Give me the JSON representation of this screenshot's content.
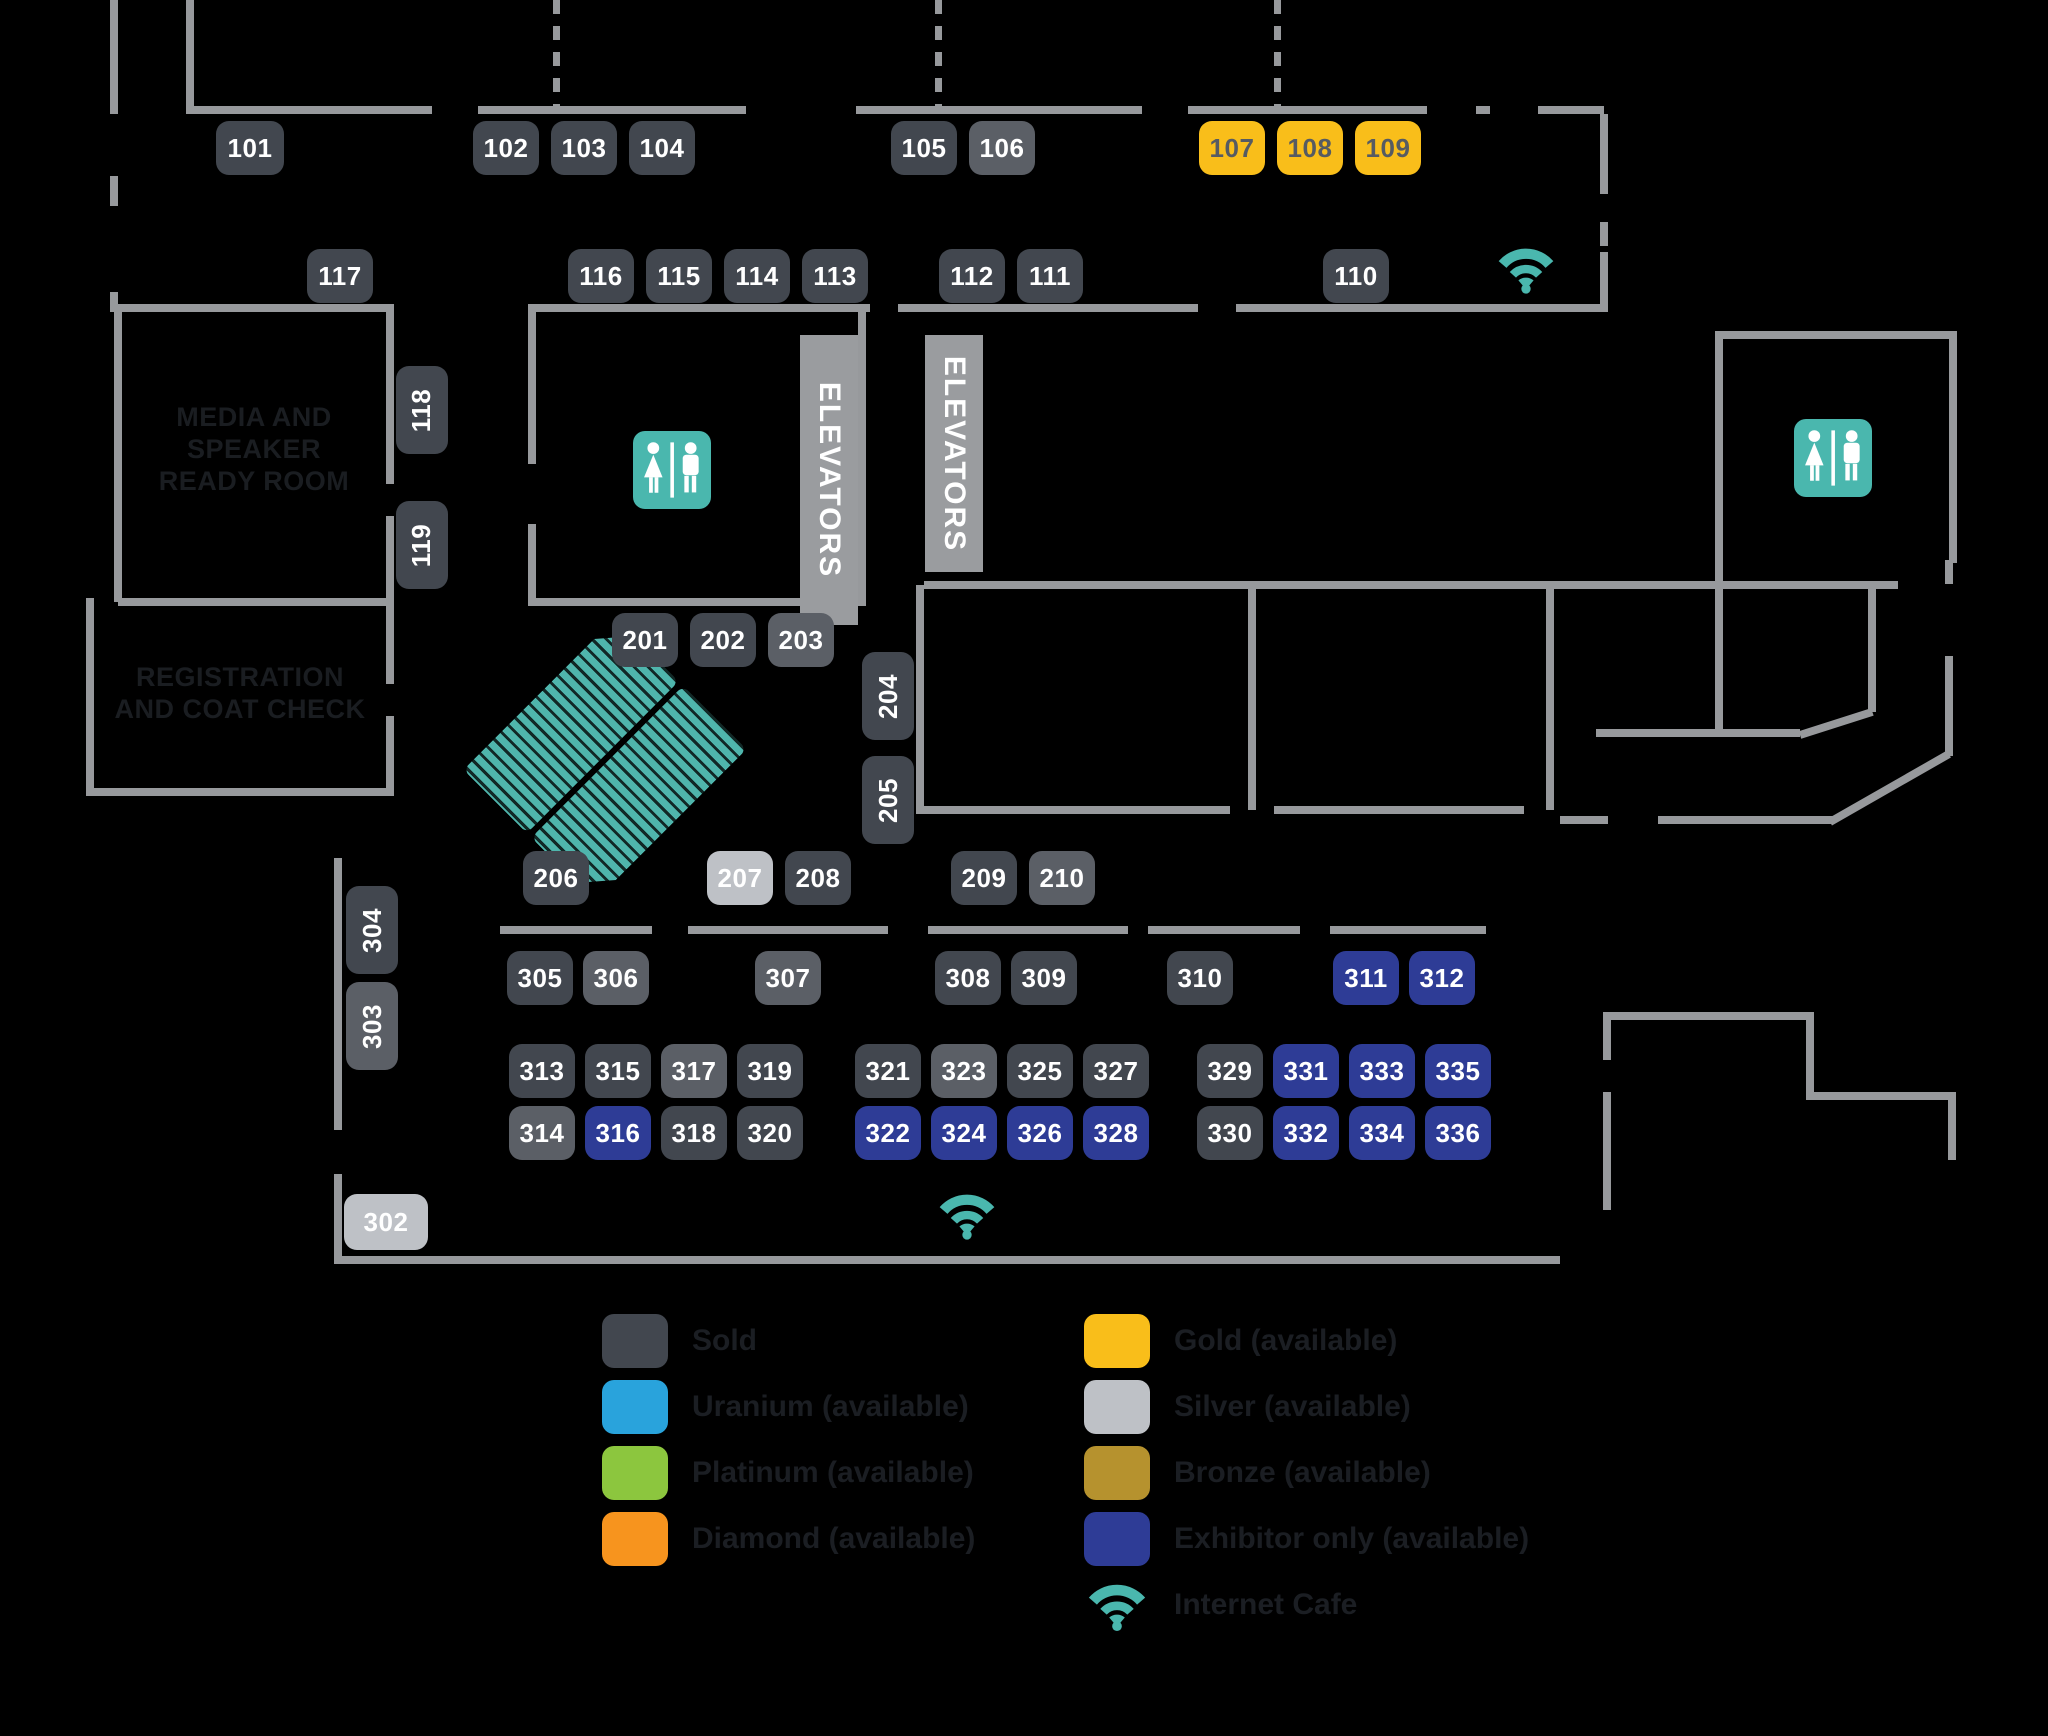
{
  "map": {
    "colors": {
      "background": "#000000",
      "wall": "#97999C",
      "sold": "#42474F",
      "sold_alt": "#5B5F66",
      "gold": "#F9BE1A",
      "silver": "#BEC1C6",
      "exhibitor": "#2E3C96",
      "uranium": "#29A3DC",
      "platinum": "#8CC63E",
      "diamond": "#F7941E",
      "bronze": "#B6922E",
      "teal_icon": "#4AB7AE",
      "gold_text": "#565B62",
      "room_label_text": "#1A1D21"
    },
    "booths": [
      {
        "id": "101",
        "cx": 250,
        "cy": 148,
        "w": 68,
        "h": 54,
        "status": "sold"
      },
      {
        "id": "102",
        "cx": 506,
        "cy": 148,
        "w": 66,
        "h": 54,
        "status": "sold"
      },
      {
        "id": "103",
        "cx": 584,
        "cy": 148,
        "w": 66,
        "h": 54,
        "status": "sold"
      },
      {
        "id": "104",
        "cx": 662,
        "cy": 148,
        "w": 66,
        "h": 54,
        "status": "sold"
      },
      {
        "id": "105",
        "cx": 924,
        "cy": 148,
        "w": 66,
        "h": 54,
        "status": "sold"
      },
      {
        "id": "106",
        "cx": 1002,
        "cy": 148,
        "w": 66,
        "h": 54,
        "status": "sold_alt"
      },
      {
        "id": "107",
        "cx": 1232,
        "cy": 148,
        "w": 66,
        "h": 54,
        "status": "gold"
      },
      {
        "id": "108",
        "cx": 1310,
        "cy": 148,
        "w": 66,
        "h": 54,
        "status": "gold"
      },
      {
        "id": "109",
        "cx": 1388,
        "cy": 148,
        "w": 66,
        "h": 54,
        "status": "gold"
      },
      {
        "id": "117",
        "cx": 340,
        "cy": 276,
        "w": 66,
        "h": 54,
        "status": "sold"
      },
      {
        "id": "116",
        "cx": 601,
        "cy": 276,
        "w": 66,
        "h": 54,
        "status": "sold"
      },
      {
        "id": "115",
        "cx": 679,
        "cy": 276,
        "w": 66,
        "h": 54,
        "status": "sold"
      },
      {
        "id": "114",
        "cx": 757,
        "cy": 276,
        "w": 66,
        "h": 54,
        "status": "sold"
      },
      {
        "id": "113",
        "cx": 835,
        "cy": 276,
        "w": 66,
        "h": 54,
        "status": "sold"
      },
      {
        "id": "112",
        "cx": 972,
        "cy": 276,
        "w": 66,
        "h": 54,
        "status": "sold"
      },
      {
        "id": "111",
        "cx": 1050,
        "cy": 276,
        "w": 66,
        "h": 54,
        "status": "sold"
      },
      {
        "id": "110",
        "cx": 1356,
        "cy": 276,
        "w": 66,
        "h": 54,
        "status": "sold"
      },
      {
        "id": "118",
        "cx": 422,
        "cy": 410,
        "w": 52,
        "h": 88,
        "status": "sold",
        "vertical": true
      },
      {
        "id": "119",
        "cx": 422,
        "cy": 545,
        "w": 52,
        "h": 88,
        "status": "sold",
        "vertical": true
      },
      {
        "id": "201",
        "cx": 645,
        "cy": 640,
        "w": 66,
        "h": 54,
        "status": "sold"
      },
      {
        "id": "202",
        "cx": 723,
        "cy": 640,
        "w": 66,
        "h": 54,
        "status": "sold"
      },
      {
        "id": "203",
        "cx": 801,
        "cy": 640,
        "w": 66,
        "h": 54,
        "status": "sold_alt"
      },
      {
        "id": "204",
        "cx": 888,
        "cy": 696,
        "w": 52,
        "h": 88,
        "status": "sold",
        "vertical": true
      },
      {
        "id": "205",
        "cx": 888,
        "cy": 800,
        "w": 52,
        "h": 88,
        "status": "sold",
        "vertical": true
      },
      {
        "id": "206",
        "cx": 556,
        "cy": 878,
        "w": 66,
        "h": 54,
        "status": "sold"
      },
      {
        "id": "207",
        "cx": 740,
        "cy": 878,
        "w": 66,
        "h": 54,
        "status": "silver"
      },
      {
        "id": "208",
        "cx": 818,
        "cy": 878,
        "w": 66,
        "h": 54,
        "status": "sold"
      },
      {
        "id": "209",
        "cx": 984,
        "cy": 878,
        "w": 66,
        "h": 54,
        "status": "sold"
      },
      {
        "id": "210",
        "cx": 1062,
        "cy": 878,
        "w": 66,
        "h": 54,
        "status": "sold_alt"
      },
      {
        "id": "304",
        "cx": 372,
        "cy": 930,
        "w": 52,
        "h": 88,
        "status": "sold",
        "vertical": true
      },
      {
        "id": "303",
        "cx": 372,
        "cy": 1026,
        "w": 52,
        "h": 88,
        "status": "sold_alt",
        "vertical": true
      },
      {
        "id": "305",
        "cx": 540,
        "cy": 978,
        "w": 66,
        "h": 54,
        "status": "sold"
      },
      {
        "id": "306",
        "cx": 616,
        "cy": 978,
        "w": 66,
        "h": 54,
        "status": "sold_alt"
      },
      {
        "id": "307",
        "cx": 788,
        "cy": 978,
        "w": 66,
        "h": 54,
        "status": "sold_alt"
      },
      {
        "id": "308",
        "cx": 968,
        "cy": 978,
        "w": 66,
        "h": 54,
        "status": "sold"
      },
      {
        "id": "309",
        "cx": 1044,
        "cy": 978,
        "w": 66,
        "h": 54,
        "status": "sold"
      },
      {
        "id": "310",
        "cx": 1200,
        "cy": 978,
        "w": 66,
        "h": 54,
        "status": "sold"
      },
      {
        "id": "311",
        "cx": 1366,
        "cy": 978,
        "w": 66,
        "h": 54,
        "status": "exhibitor"
      },
      {
        "id": "312",
        "cx": 1442,
        "cy": 978,
        "w": 66,
        "h": 54,
        "status": "exhibitor"
      },
      {
        "id": "302",
        "cx": 386,
        "cy": 1222,
        "w": 84,
        "h": 56,
        "status": "silver"
      },
      {
        "id": "313",
        "cx": 542,
        "cy": 1071,
        "w": 66,
        "h": 54,
        "status": "sold"
      },
      {
        "id": "315",
        "cx": 618,
        "cy": 1071,
        "w": 66,
        "h": 54,
        "status": "sold"
      },
      {
        "id": "317",
        "cx": 694,
        "cy": 1071,
        "w": 66,
        "h": 54,
        "status": "sold_alt"
      },
      {
        "id": "319",
        "cx": 770,
        "cy": 1071,
        "w": 66,
        "h": 54,
        "status": "sold"
      },
      {
        "id": "314",
        "cx": 542,
        "cy": 1133,
        "w": 66,
        "h": 54,
        "status": "sold_alt"
      },
      {
        "id": "316",
        "cx": 618,
        "cy": 1133,
        "w": 66,
        "h": 54,
        "status": "exhibitor"
      },
      {
        "id": "318",
        "cx": 694,
        "cy": 1133,
        "w": 66,
        "h": 54,
        "status": "sold"
      },
      {
        "id": "320",
        "cx": 770,
        "cy": 1133,
        "w": 66,
        "h": 54,
        "status": "sold"
      },
      {
        "id": "321",
        "cx": 888,
        "cy": 1071,
        "w": 66,
        "h": 54,
        "status": "sold"
      },
      {
        "id": "323",
        "cx": 964,
        "cy": 1071,
        "w": 66,
        "h": 54,
        "status": "sold_alt"
      },
      {
        "id": "325",
        "cx": 1040,
        "cy": 1071,
        "w": 66,
        "h": 54,
        "status": "sold"
      },
      {
        "id": "327",
        "cx": 1116,
        "cy": 1071,
        "w": 66,
        "h": 54,
        "status": "sold"
      },
      {
        "id": "322",
        "cx": 888,
        "cy": 1133,
        "w": 66,
        "h": 54,
        "status": "exhibitor"
      },
      {
        "id": "324",
        "cx": 964,
        "cy": 1133,
        "w": 66,
        "h": 54,
        "status": "exhibitor"
      },
      {
        "id": "326",
        "cx": 1040,
        "cy": 1133,
        "w": 66,
        "h": 54,
        "status": "exhibitor"
      },
      {
        "id": "328",
        "cx": 1116,
        "cy": 1133,
        "w": 66,
        "h": 54,
        "status": "exhibitor"
      },
      {
        "id": "329",
        "cx": 1230,
        "cy": 1071,
        "w": 66,
        "h": 54,
        "status": "sold"
      },
      {
        "id": "331",
        "cx": 1306,
        "cy": 1071,
        "w": 66,
        "h": 54,
        "status": "exhibitor"
      },
      {
        "id": "333",
        "cx": 1382,
        "cy": 1071,
        "w": 66,
        "h": 54,
        "status": "exhibitor"
      },
      {
        "id": "335",
        "cx": 1458,
        "cy": 1071,
        "w": 66,
        "h": 54,
        "status": "exhibitor"
      },
      {
        "id": "330",
        "cx": 1230,
        "cy": 1133,
        "w": 66,
        "h": 54,
        "status": "sold"
      },
      {
        "id": "332",
        "cx": 1306,
        "cy": 1133,
        "w": 66,
        "h": 54,
        "status": "exhibitor"
      },
      {
        "id": "334",
        "cx": 1382,
        "cy": 1133,
        "w": 66,
        "h": 54,
        "status": "exhibitor"
      },
      {
        "id": "336",
        "cx": 1458,
        "cy": 1133,
        "w": 66,
        "h": 54,
        "status": "exhibitor"
      }
    ],
    "rooms": [
      {
        "name": "media-speaker-ready-room",
        "label": "MEDIA AND\nSPEAKER\nREADY ROOM",
        "cx": 254,
        "cy": 452,
        "w": 280
      },
      {
        "name": "registration-coat-check",
        "label": "REGISTRATION\nAND COAT CHECK",
        "cx": 240,
        "cy": 712,
        "w": 310
      }
    ],
    "elevators": [
      {
        "label": "ELEVATORS",
        "x": 800,
        "y": 335,
        "w": 58,
        "h": 290
      },
      {
        "label": "ELEVATORS",
        "x": 925,
        "y": 335,
        "w": 58,
        "h": 237
      }
    ],
    "icons": [
      {
        "type": "restroom-icon",
        "cx": 672,
        "cy": 470,
        "size": 78
      },
      {
        "type": "restroom-icon",
        "cx": 1833,
        "cy": 458,
        "size": 78
      },
      {
        "type": "wifi-icon",
        "cx": 1526,
        "cy": 272,
        "size": 60
      },
      {
        "type": "wifi-icon",
        "cx": 967,
        "cy": 1218,
        "size": 60
      }
    ],
    "escalator": {
      "x": 512,
      "y": 652,
      "rotation": 45
    },
    "walls": [
      [
        110,
        0,
        8,
        114
      ],
      [
        186,
        0,
        8,
        114
      ],
      [
        190,
        106,
        242,
        8
      ],
      [
        478,
        106,
        268,
        8
      ],
      [
        856,
        106,
        286,
        8
      ],
      [
        1188,
        106,
        239,
        8
      ],
      [
        1476,
        106,
        14,
        8
      ],
      [
        1538,
        106,
        66,
        8
      ],
      [
        1600,
        114,
        8,
        80
      ],
      [
        1600,
        222,
        8,
        24
      ],
      [
        1600,
        252,
        8,
        60
      ],
      [
        532,
        304,
        338,
        8
      ],
      [
        898,
        304,
        300,
        8
      ],
      [
        1236,
        304,
        368,
        8
      ],
      [
        114,
        304,
        8,
        298
      ],
      [
        118,
        304,
        272,
        8
      ],
      [
        386,
        304,
        8,
        180
      ],
      [
        386,
        516,
        8,
        90
      ],
      [
        118,
        598,
        272,
        8
      ],
      [
        86,
        598,
        8,
        198
      ],
      [
        90,
        788,
        300,
        8
      ],
      [
        386,
        598,
        8,
        86
      ],
      [
        386,
        716,
        8,
        80
      ],
      [
        528,
        304,
        8,
        160
      ],
      [
        528,
        524,
        8,
        82
      ],
      [
        532,
        598,
        330,
        8
      ],
      [
        858,
        304,
        8,
        302
      ],
      [
        916,
        585,
        8,
        229
      ],
      [
        916,
        806,
        314,
        8
      ],
      [
        1274,
        806,
        250,
        8
      ],
      [
        924,
        581,
        974,
        8
      ],
      [
        1248,
        589,
        8,
        221
      ],
      [
        1546,
        589,
        8,
        221
      ],
      [
        1715,
        589,
        8,
        148
      ],
      [
        1868,
        589,
        8,
        123
      ],
      [
        1596,
        729,
        204,
        8
      ],
      [
        1945,
        560,
        8,
        24
      ],
      [
        1945,
        656,
        8,
        100
      ],
      [
        1560,
        816,
        48,
        8
      ],
      [
        1658,
        816,
        176,
        8
      ],
      [
        1715,
        331,
        8,
        254
      ],
      [
        1719,
        331,
        238,
        8
      ],
      [
        1949,
        331,
        8,
        232
      ],
      [
        1603,
        1012,
        8,
        48
      ],
      [
        1603,
        1092,
        8,
        118
      ],
      [
        1607,
        1012,
        203,
        8
      ],
      [
        1806,
        1012,
        8,
        88
      ],
      [
        1810,
        1092,
        146,
        8
      ],
      [
        1948,
        1100,
        8,
        60
      ],
      [
        500,
        926,
        152,
        8
      ],
      [
        688,
        926,
        200,
        8
      ],
      [
        928,
        926,
        200,
        8
      ],
      [
        1148,
        926,
        152,
        8
      ],
      [
        1330,
        926,
        156,
        8
      ],
      [
        334,
        858,
        8,
        272
      ],
      [
        334,
        1174,
        8,
        90
      ],
      [
        338,
        1256,
        1222,
        8
      ],
      [
        110,
        176,
        8,
        30
      ],
      [
        110,
        292,
        8,
        20
      ]
    ],
    "dashed_walls": [
      [
        553,
        0,
        106
      ],
      [
        935,
        0,
        106
      ],
      [
        1274,
        0,
        106
      ]
    ],
    "diagonals": [
      {
        "x1": 1800,
        "y1": 735,
        "x2": 1872,
        "y2": 712
      },
      {
        "x1": 1830,
        "y1": 822,
        "x2": 1949,
        "y2": 754
      }
    ]
  },
  "legend": {
    "left": [
      {
        "label": "Sold",
        "swatch": "#42474F"
      },
      {
        "label": "Uranium (available)",
        "swatch": "#29A3DC"
      },
      {
        "label": "Platinum (available)",
        "swatch": "#8CC63E"
      },
      {
        "label": "Diamond (available)",
        "swatch": "#F7941E"
      }
    ],
    "right": [
      {
        "label": "Gold (available)",
        "swatch": "#F9BE1A"
      },
      {
        "label": "Silver (available)",
        "swatch": "#BEC1C6"
      },
      {
        "label": "Bronze (available)",
        "swatch": "#B6922E"
      },
      {
        "label": "Exhibitor only (available)",
        "swatch": "#2E3C96"
      },
      {
        "label": "Internet Cafe",
        "swatch": "wifi"
      }
    ],
    "layout": {
      "left_x": 602,
      "right_x": 1084,
      "row_start_y": 1314,
      "row_pitch": 66
    }
  }
}
